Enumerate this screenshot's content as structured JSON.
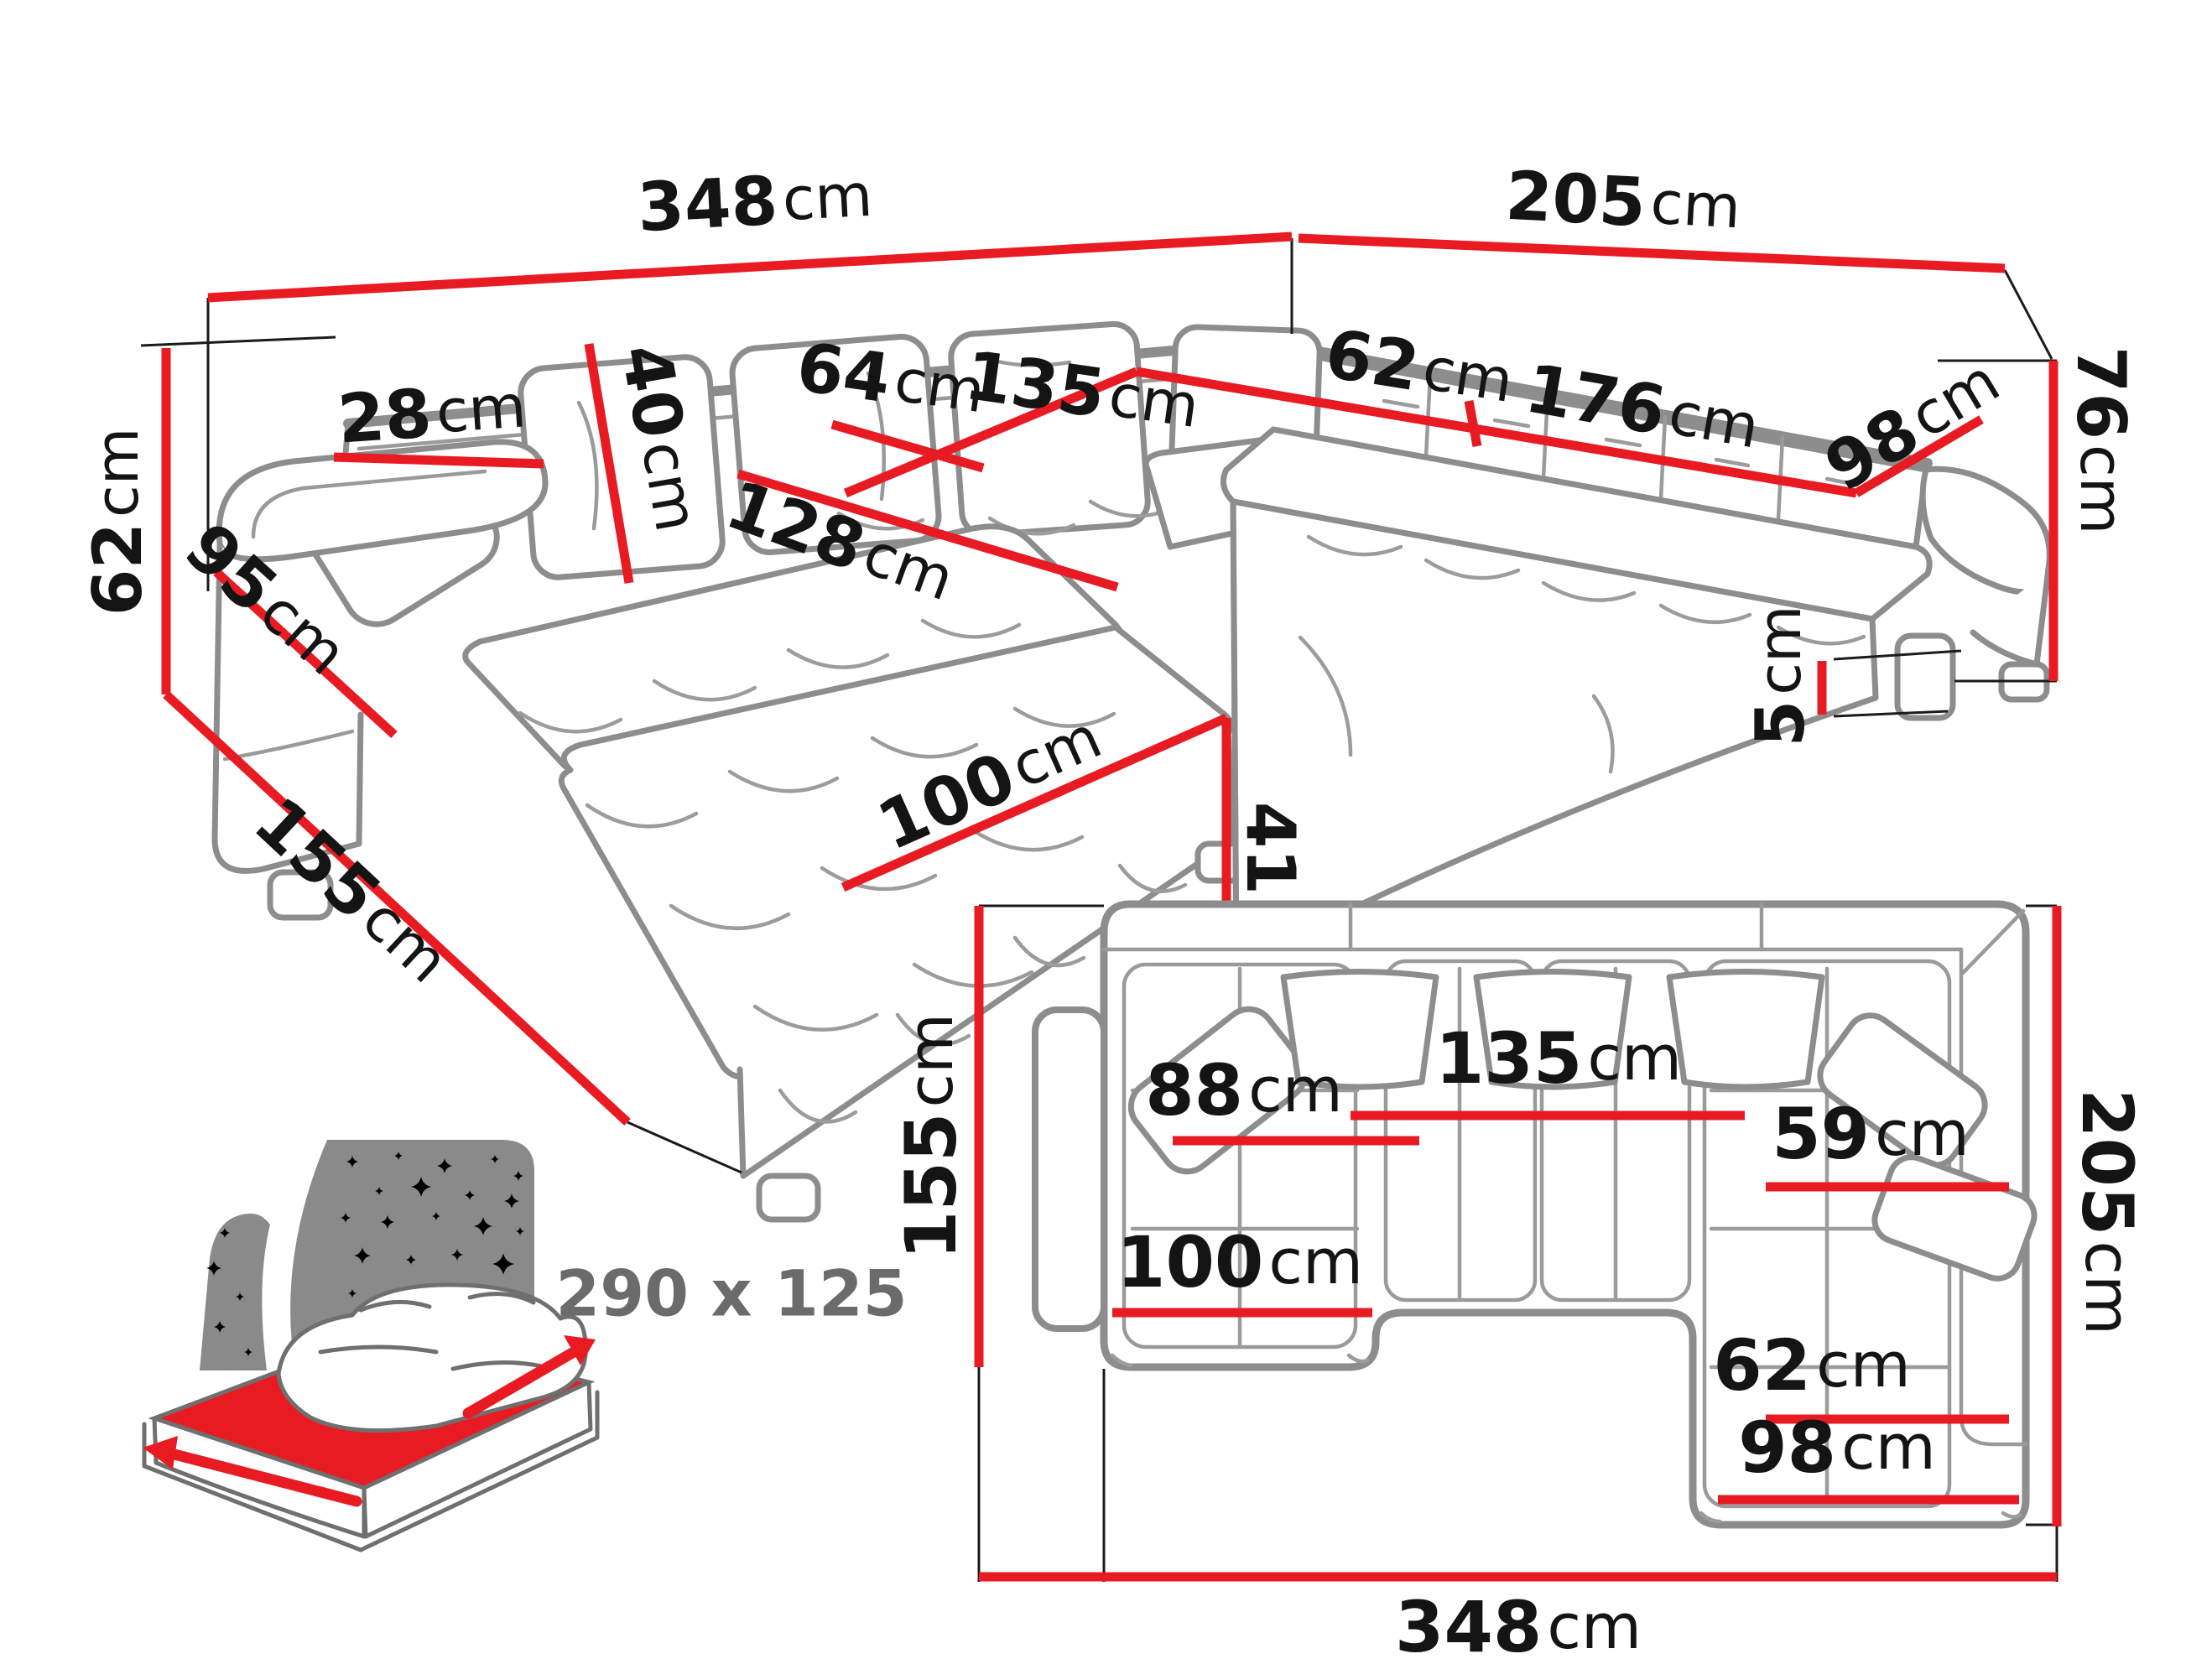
{
  "colors": {
    "dimension_red": "#e81b23",
    "outline_gray": "#8d8d8d",
    "text_black": "#141414",
    "bed_gray": "#8a8a8a",
    "bed_text_gray": "#6b6b6b"
  },
  "persp": {
    "back_width": {
      "v": "348",
      "u": "cm"
    },
    "side_width": {
      "v": "205",
      "u": "cm"
    },
    "back_height": {
      "v": "76",
      "u": "cm"
    },
    "armrest_height": {
      "v": "62",
      "u": "cm"
    },
    "chaise_depth": {
      "v": "155",
      "u": "cm"
    },
    "armrest_side": {
      "v": "95",
      "u": "cm"
    },
    "armrest_top_width": {
      "v": "28",
      "u": "cm"
    },
    "back_cushion_height": {
      "v": "40",
      "u": "cm"
    },
    "seat_depth_back": {
      "v": "64",
      "u": "cm"
    },
    "middle_seat_width": {
      "v": "135",
      "u": "cm"
    },
    "corner_seat_depth": {
      "v": "62",
      "u": "cm"
    },
    "right_seat_length": {
      "v": "176",
      "u": "cm"
    },
    "right_seat_width": {
      "v": "98",
      "u": "cm"
    },
    "chaise_inner_length": {
      "v": "128",
      "u": "cm"
    },
    "chaise_width": {
      "v": "100",
      "u": "cm"
    },
    "seat_height": {
      "v": "41",
      "u": "cm"
    },
    "leg_height": {
      "v": "5",
      "u": "cm"
    }
  },
  "plan": {
    "left_depth": {
      "v": "155",
      "u": "cm"
    },
    "right_depth": {
      "v": "205",
      "u": "cm"
    },
    "total_width": {
      "v": "348",
      "u": "cm"
    },
    "chaise_seat_width": {
      "v": "88",
      "u": "cm"
    },
    "middle_seat_width": {
      "v": "135",
      "u": "cm"
    },
    "right_seat_depth_upper": {
      "v": "59",
      "u": "cm"
    },
    "right_seat_depth_lower": {
      "v": "62",
      "u": "cm"
    },
    "chaise_outer_width": {
      "v": "100",
      "u": "cm"
    },
    "right_outer_width": {
      "v": "98",
      "u": "cm"
    }
  },
  "bed": {
    "sleeping_area": "290 x 125"
  }
}
